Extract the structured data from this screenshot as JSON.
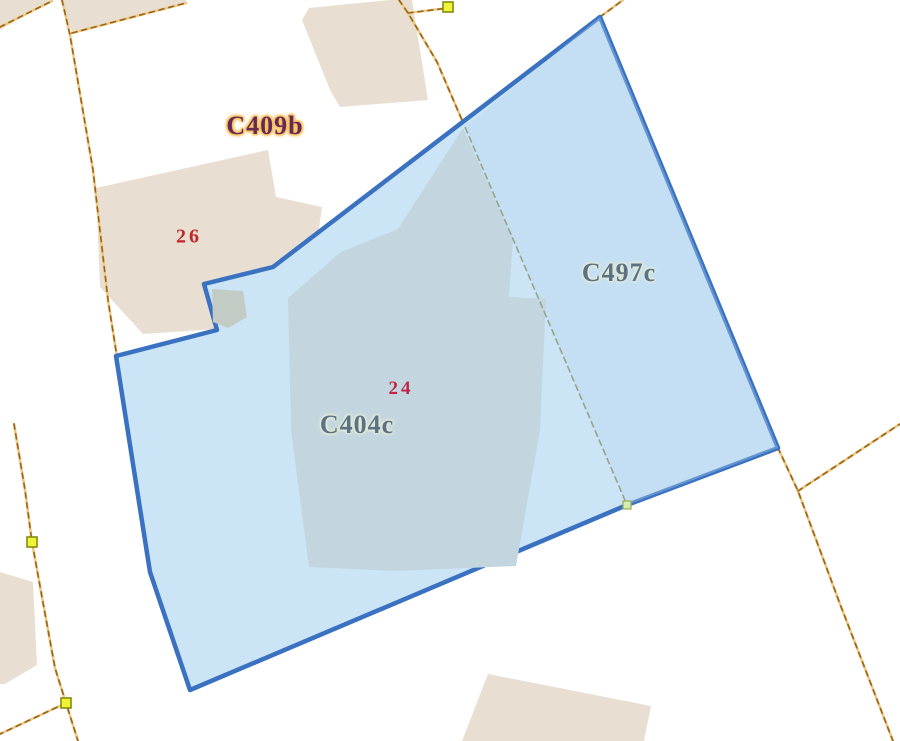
{
  "map_view": {
    "type": "cadastral-parcel-map",
    "parcel_labels": {
      "c409b": {
        "text": "C409b",
        "color": "#682a55",
        "halo_color": "#f4c468"
      },
      "c404c": {
        "text": "C404c",
        "color": "#5c7183",
        "halo_color": "#dfe9db"
      },
      "c497c": {
        "text": "C497c",
        "color": "#5c7183",
        "halo_color": "#dfe9db"
      }
    },
    "house_numbers": {
      "n26": {
        "text": "26",
        "color": "#c1272d"
      },
      "n24": {
        "text": "24",
        "color": "#bf2745"
      }
    },
    "colors": {
      "background": "#ffffff",
      "building_fill": "#e8dfd2",
      "selected_building_fill": "#c3d5df",
      "inner_building_gray": "#c3ccc4",
      "selection_fill": "#cbe4f6",
      "selection_fill_east_tint": "#b7d8f0",
      "selection_stroke": "#3a72c1",
      "boundary_underlay": "#ecc989",
      "boundary_dash": "#9a6616",
      "inner_divider": "#8f9f7d",
      "vertex_marker_fill": "#f0f436",
      "vertex_marker_stroke": "#858a12",
      "divider_node_fill": "#d6ecae",
      "divider_node_stroke": "#8fae57"
    }
  }
}
